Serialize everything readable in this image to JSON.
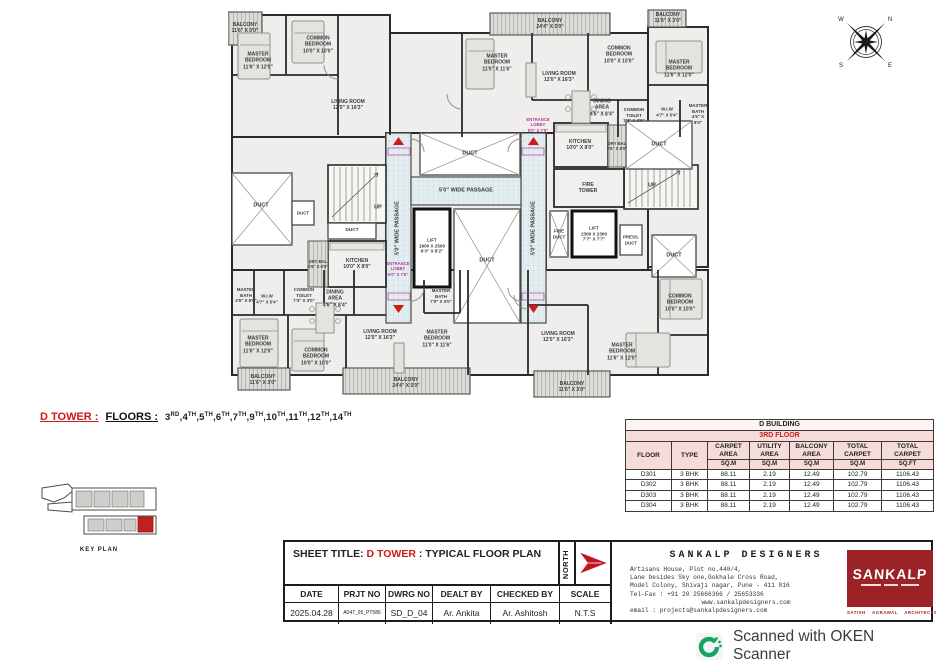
{
  "plan": {
    "labels": [
      {
        "t": "BALCONY\n24'4\" X 5'0\"",
        "x": 322,
        "y": 19,
        "name": "balcony-label"
      },
      {
        "t": "MASTER\nBEDROOM\n11'0\" X 11'6\"",
        "x": 269,
        "y": 58,
        "name": "bedroom-label"
      },
      {
        "t": "LIVING ROOM\n12'0\" X 16'3\"",
        "x": 331,
        "y": 72,
        "name": "living-room-label"
      },
      {
        "t": "COMMON\nBEDROOM\n10'0\" X 10'0\"",
        "x": 391,
        "y": 50,
        "name": "bedroom-label"
      },
      {
        "t": "MASTER\nBEDROOM\n11'6\" X 12'0\"",
        "x": 451,
        "y": 64,
        "name": "bedroom-label"
      },
      {
        "t": "BALCONY\n11'6\" X 3'0\"",
        "x": 440,
        "y": 13,
        "name": "balcony-label"
      },
      {
        "t": "DINING\nAREA\n4'6\" X 8'4\"",
        "x": 374,
        "y": 103,
        "name": "dining-label"
      },
      {
        "t": "COMMON\nTOILET\n7'3\" X 3'0\"",
        "x": 406,
        "y": 110,
        "fs": 4.4,
        "name": "toilet-label"
      },
      {
        "t": "W.I.W\n4'7\" X 5'4\"",
        "x": 439,
        "y": 107,
        "fs": 4.4,
        "name": "wiw-label"
      },
      {
        "t": "MASTER\nBATH\n4'5\" X 8'0\"",
        "x": 470,
        "y": 109,
        "fs": 4.4,
        "name": "bath-label"
      },
      {
        "t": "KITCHEN\n10'0\" X 8'0\"",
        "x": 352,
        "y": 140,
        "name": "kitchen-label"
      },
      {
        "t": "DRY BAL\n2'6\" X 8'0\"",
        "x": 389,
        "y": 141,
        "fs": 4.2,
        "name": "dry-balcony-label"
      },
      {
        "t": "DUCT",
        "x": 431,
        "y": 140,
        "fs": 5.5,
        "name": "duct-label"
      },
      {
        "t": "FIRE\nTOWER",
        "x": 360,
        "y": 183,
        "name": "fire-tower-label"
      },
      {
        "t": "UP",
        "x": 424,
        "y": 181,
        "fs": 5.5,
        "name": "stairs-up-label"
      },
      {
        "t": "FIRE\nDUCT",
        "x": 331,
        "y": 229,
        "fs": 4.5,
        "name": "fire-duct-label"
      },
      {
        "t": "LIFT\n2300 X 2300\n7'7\" X 7'7\"",
        "x": 366,
        "y": 229,
        "fs": 4.6,
        "name": "lift-label"
      },
      {
        "t": "PRESS.\nDUCT",
        "x": 403,
        "y": 235,
        "fs": 4.4,
        "name": "duct-label"
      },
      {
        "t": "DUCT",
        "x": 446,
        "y": 251,
        "fs": 5.5,
        "name": "duct-label"
      },
      {
        "t": "5'0\" WIDE PASSAGE",
        "x": 238,
        "y": 186,
        "fs": 5.5,
        "name": "passage-label"
      },
      {
        "t": "5'0\" WIDE PASSAGE",
        "x": 170,
        "y": 223,
        "fs": 5.5,
        "r": 1,
        "name": "passage-label"
      },
      {
        "t": "5'0\" WIDE PASSAGE",
        "x": 306,
        "y": 223,
        "fs": 5.5,
        "r": 1,
        "name": "passage-label"
      },
      {
        "t": "DUCT",
        "x": 242,
        "y": 149,
        "fs": 5.5,
        "name": "duct-label"
      },
      {
        "t": "LIFT\n1900 X 2500\n6'3\" X 8'2\"",
        "x": 204,
        "y": 241,
        "fs": 4.6,
        "name": "lift-label"
      },
      {
        "t": "DUCT",
        "x": 259,
        "y": 256,
        "fs": 5.5,
        "name": "duct-label"
      },
      {
        "t": "UP",
        "x": 150,
        "y": 203,
        "fs": 5.5,
        "name": "stairs-up-label"
      },
      {
        "t": "DUCT",
        "x": 33,
        "y": 201,
        "fs": 5.5,
        "name": "duct-label"
      },
      {
        "t": "DUCT",
        "x": 75,
        "y": 208,
        "fs": 4.4,
        "name": "duct-label"
      },
      {
        "t": "DUCT",
        "x": 124,
        "y": 226,
        "fs": 4.8,
        "name": "duct-label"
      },
      {
        "t": "KITCHEN\n10'0\" X 8'0\"",
        "x": 129,
        "y": 259,
        "name": "kitchen-label"
      },
      {
        "t": "DRY BAL\n2'6\" X 8'0\"",
        "x": 90,
        "y": 259,
        "fs": 4.2,
        "name": "dry-balcony-label"
      },
      {
        "t": "MASTER\nBATH\n4'5\" X 8'0\"",
        "x": 18,
        "y": 290,
        "fs": 4.4,
        "name": "bath-label"
      },
      {
        "t": "W.I.W\n4'7\" X 5'4\"",
        "x": 39,
        "y": 294,
        "fs": 4.4,
        "name": "wiw-label"
      },
      {
        "t": "COMMON\nTOILET\n7'3\" X 3'0\"",
        "x": 76,
        "y": 290,
        "fs": 4.4,
        "name": "toilet-label"
      },
      {
        "t": "DINING\nAREA\n4'6\" X 8'4\"",
        "x": 107,
        "y": 294,
        "name": "dining-label"
      },
      {
        "t": "LIVING ROOM\n12'0\" X 16'3\"",
        "x": 152,
        "y": 330,
        "name": "living-room-label"
      },
      {
        "t": "MASTER\nBEDROOM\n11'0\" X 11'6\"",
        "x": 209,
        "y": 334,
        "name": "bedroom-label"
      },
      {
        "t": "MASTER\nBEDROOM\n11'6\" X 12'0\"",
        "x": 30,
        "y": 340,
        "name": "bedroom-label"
      },
      {
        "t": "COMMON\nBEDROOM\n10'0\" X 10'0\"",
        "x": 88,
        "y": 352,
        "name": "bedroom-label"
      },
      {
        "t": "MASTER\nBATH\n7'0\" X 3'0\"",
        "x": 213,
        "y": 291,
        "fs": 4.4,
        "name": "bath-label"
      },
      {
        "t": "BALCONY\n11'6\" X 3'0\"",
        "x": 35,
        "y": 375,
        "name": "balcony-label"
      },
      {
        "t": "BALCONY\n24'4\" X 5'0\"",
        "x": 178,
        "y": 378,
        "name": "balcony-label"
      },
      {
        "t": "LIVING ROOM\n12'0\" X 16'3\"",
        "x": 330,
        "y": 332,
        "name": "living-room-label"
      },
      {
        "t": "MASTER\nBEDROOM\n11'6\" X 12'0\"",
        "x": 394,
        "y": 347,
        "name": "bedroom-label"
      },
      {
        "t": "COMMON\nBEDROOM\n10'0\" X 10'0\"",
        "x": 452,
        "y": 298,
        "name": "bedroom-label"
      },
      {
        "t": "BALCONY\n11'6\" X 3'0\"",
        "x": 344,
        "y": 382,
        "name": "balcony-label"
      },
      {
        "t": "MASTER\nBEDROOM\n11'6\" X 12'0\"",
        "x": 30,
        "y": 56,
        "name": "bedroom-label"
      },
      {
        "t": "COMMON\nBEDROOM\n10'0\" X 10'0\"",
        "x": 90,
        "y": 40,
        "name": "bedroom-label"
      },
      {
        "t": "LIVING ROOM\n12'0\" X 16'3\"",
        "x": 120,
        "y": 100,
        "name": "living-room-label"
      },
      {
        "t": "BALCONY\n11'6\" X 3'0\"",
        "x": 17,
        "y": 23,
        "name": "balcony-label"
      },
      {
        "t": "ENTRANCE\nLOBBY\n5'0\" X 7'5\"",
        "x": 310,
        "y": 120,
        "fs": 4.2,
        "c": "#b23a98",
        "name": "entrance-lobby-label"
      },
      {
        "t": "ENTRANCE\nLOBBY\n5'0\" X 7'5\"",
        "x": 170,
        "y": 264,
        "fs": 4.2,
        "c": "#b23a98",
        "name": "entrance-lobby-label"
      }
    ]
  },
  "compass": {
    "n": "N",
    "e": "E",
    "s": "S",
    "w": "W"
  },
  "floors_line": {
    "tower": "D TOWER :",
    "floors_label": "FLOORS :",
    "floors": [
      {
        "n": "3",
        "s": "RD"
      },
      {
        "n": "4",
        "s": "TH"
      },
      {
        "n": "5",
        "s": "TH"
      },
      {
        "n": "6",
        "s": "TH"
      },
      {
        "n": "7",
        "s": "TH"
      },
      {
        "n": "9",
        "s": "TH"
      },
      {
        "n": "10",
        "s": "TH"
      },
      {
        "n": "11",
        "s": "TH"
      },
      {
        "n": "12",
        "s": "TH"
      },
      {
        "n": "14",
        "s": "TH"
      }
    ]
  },
  "area_table": {
    "title": "D BUILDING",
    "subtitle": "3RD FLOOR",
    "col_floor": "FLOOR",
    "col_type": "TYPE",
    "cols": [
      {
        "l1": "CARPET",
        "l2": "AREA",
        "unit": "SQ.M"
      },
      {
        "l1": "UTILITY",
        "l2": "AREA",
        "unit": "SQ.M"
      },
      {
        "l1": "BALCONY",
        "l2": "AREA",
        "unit": "SQ.M"
      },
      {
        "l1": "TOTAL",
        "l2": "CARPET",
        "unit": "SQ.M"
      },
      {
        "l1": "TOTAL",
        "l2": "CARPET",
        "unit": "SQ.FT"
      }
    ],
    "rows": [
      [
        "D301",
        "3 BHK",
        "88.11",
        "2.19",
        "12.49",
        "102.79",
        "1106.43"
      ],
      [
        "D302",
        "3 BHK",
        "88.11",
        "2.19",
        "12.49",
        "102.79",
        "1106.43"
      ],
      [
        "D303",
        "3 BHK",
        "88.11",
        "2.19",
        "12.49",
        "102.79",
        "1106.43"
      ],
      [
        "D304",
        "3 BHK",
        "88.11",
        "2.19",
        "12.49",
        "102.79",
        "1106.43"
      ]
    ]
  },
  "key_plan": {
    "label": "KEY PLAN"
  },
  "title_block": {
    "sheet_title_label": "SHEET TITLE:",
    "tower": "D TOWER",
    "title_rest": ": TYPICAL FLOOR PLAN",
    "north_label": "NORTH",
    "h_date": "DATE",
    "h_prjt": "PRJT NO",
    "h_dwrg": "DWRG NO",
    "h_dealt": "DEALT BY",
    "h_checked": "CHECKED BY",
    "h_scale": "SCALE",
    "v_date": "2025.04.28",
    "v_prjt": "A047_05_PT586",
    "v_dwrg": "SD_D_04",
    "v_dealt": "Ar. Ankita",
    "v_checked": "Ar. Ashitosh",
    "v_scale": "N.T.S"
  },
  "firm": {
    "name": "SANKALP DESIGNERS",
    "address1": "Artisans House, Plot no.440/4,",
    "address2": "Lane besides Sky one,Gokhale Cross Road,",
    "address3": "Model Colony, Shivaji nagar, Pune - 411 016",
    "telfax": "Tel-Fax : +91 20 25666366 / 25653336",
    "website": "www.sankalpdesigners.com",
    "email": "email : projects@sankalpdesigners.com",
    "logo_text": "SANKALP",
    "logo_sub": "SATISH AGRAWAL ARCHITECTS"
  },
  "scanner": {
    "text": "Scanned with OKEN Scanner"
  },
  "colors": {
    "accent_red": "#cc1a1a",
    "logo_maroon": "#9b2328",
    "oken_green": "#13a562",
    "table_pink": "#f5dcd9"
  }
}
